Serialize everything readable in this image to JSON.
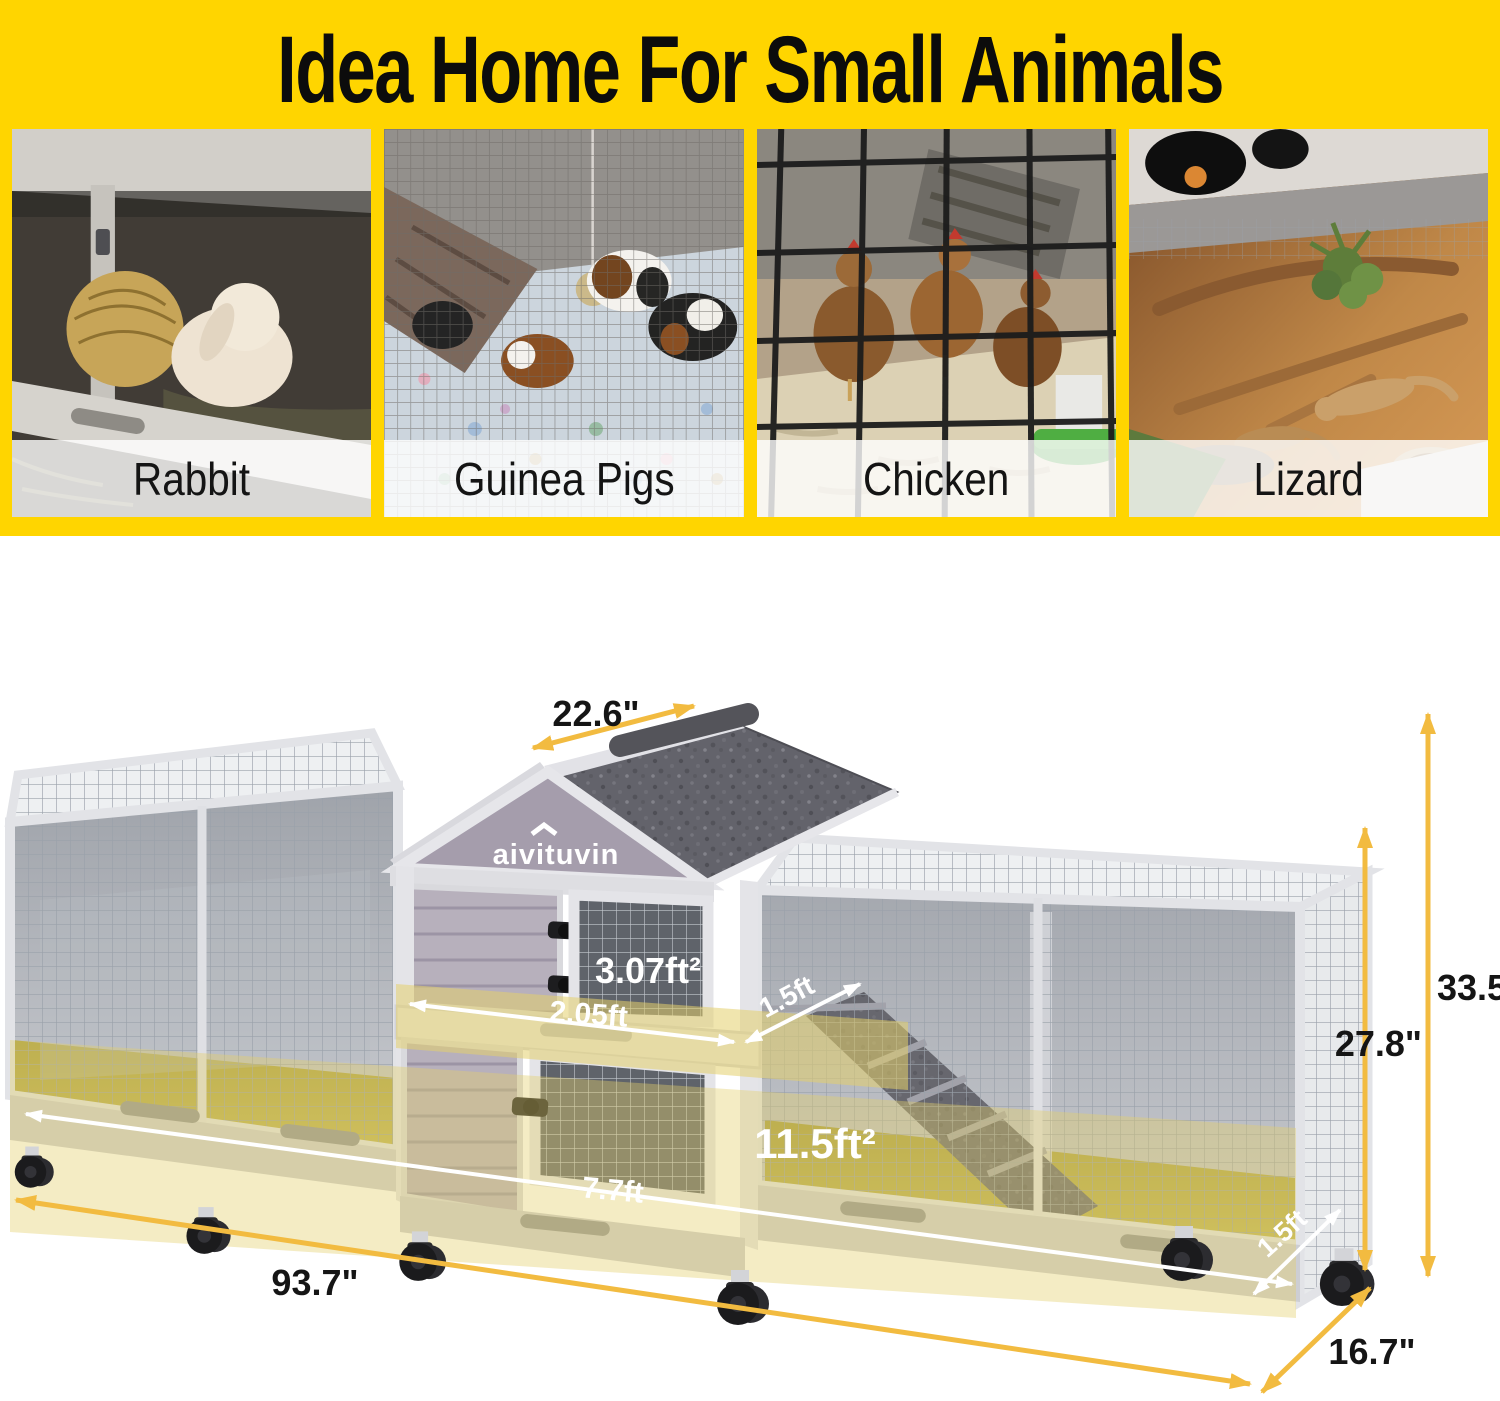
{
  "banner": {
    "title": "Idea Home For Small Animals"
  },
  "photos": [
    {
      "label": "Rabbit"
    },
    {
      "label": "Guinea Pigs"
    },
    {
      "label": "Chicken"
    },
    {
      "label": "Lizard"
    }
  ],
  "product": {
    "brand_logo": "aivituvin"
  },
  "dimensions": {
    "roof_depth": "22.6\"",
    "overall_height": "33.5\"",
    "frame_height": "27.8\"",
    "overall_length": "93.7\"",
    "overall_depth": "16.7\"",
    "hutch_floor_area": "3.07ft²",
    "hutch_floor_length": "2.05ft",
    "hutch_floor_depth": "1.5ft",
    "run_floor_area": "11.5ft²",
    "run_floor_length": "7.7ft",
    "run_floor_depth": "1.5ft"
  },
  "colors": {
    "banner_bg": "#FFD500",
    "dimension_arrow": "#F2BB40",
    "floor_highlight": "#E3CF6B"
  }
}
